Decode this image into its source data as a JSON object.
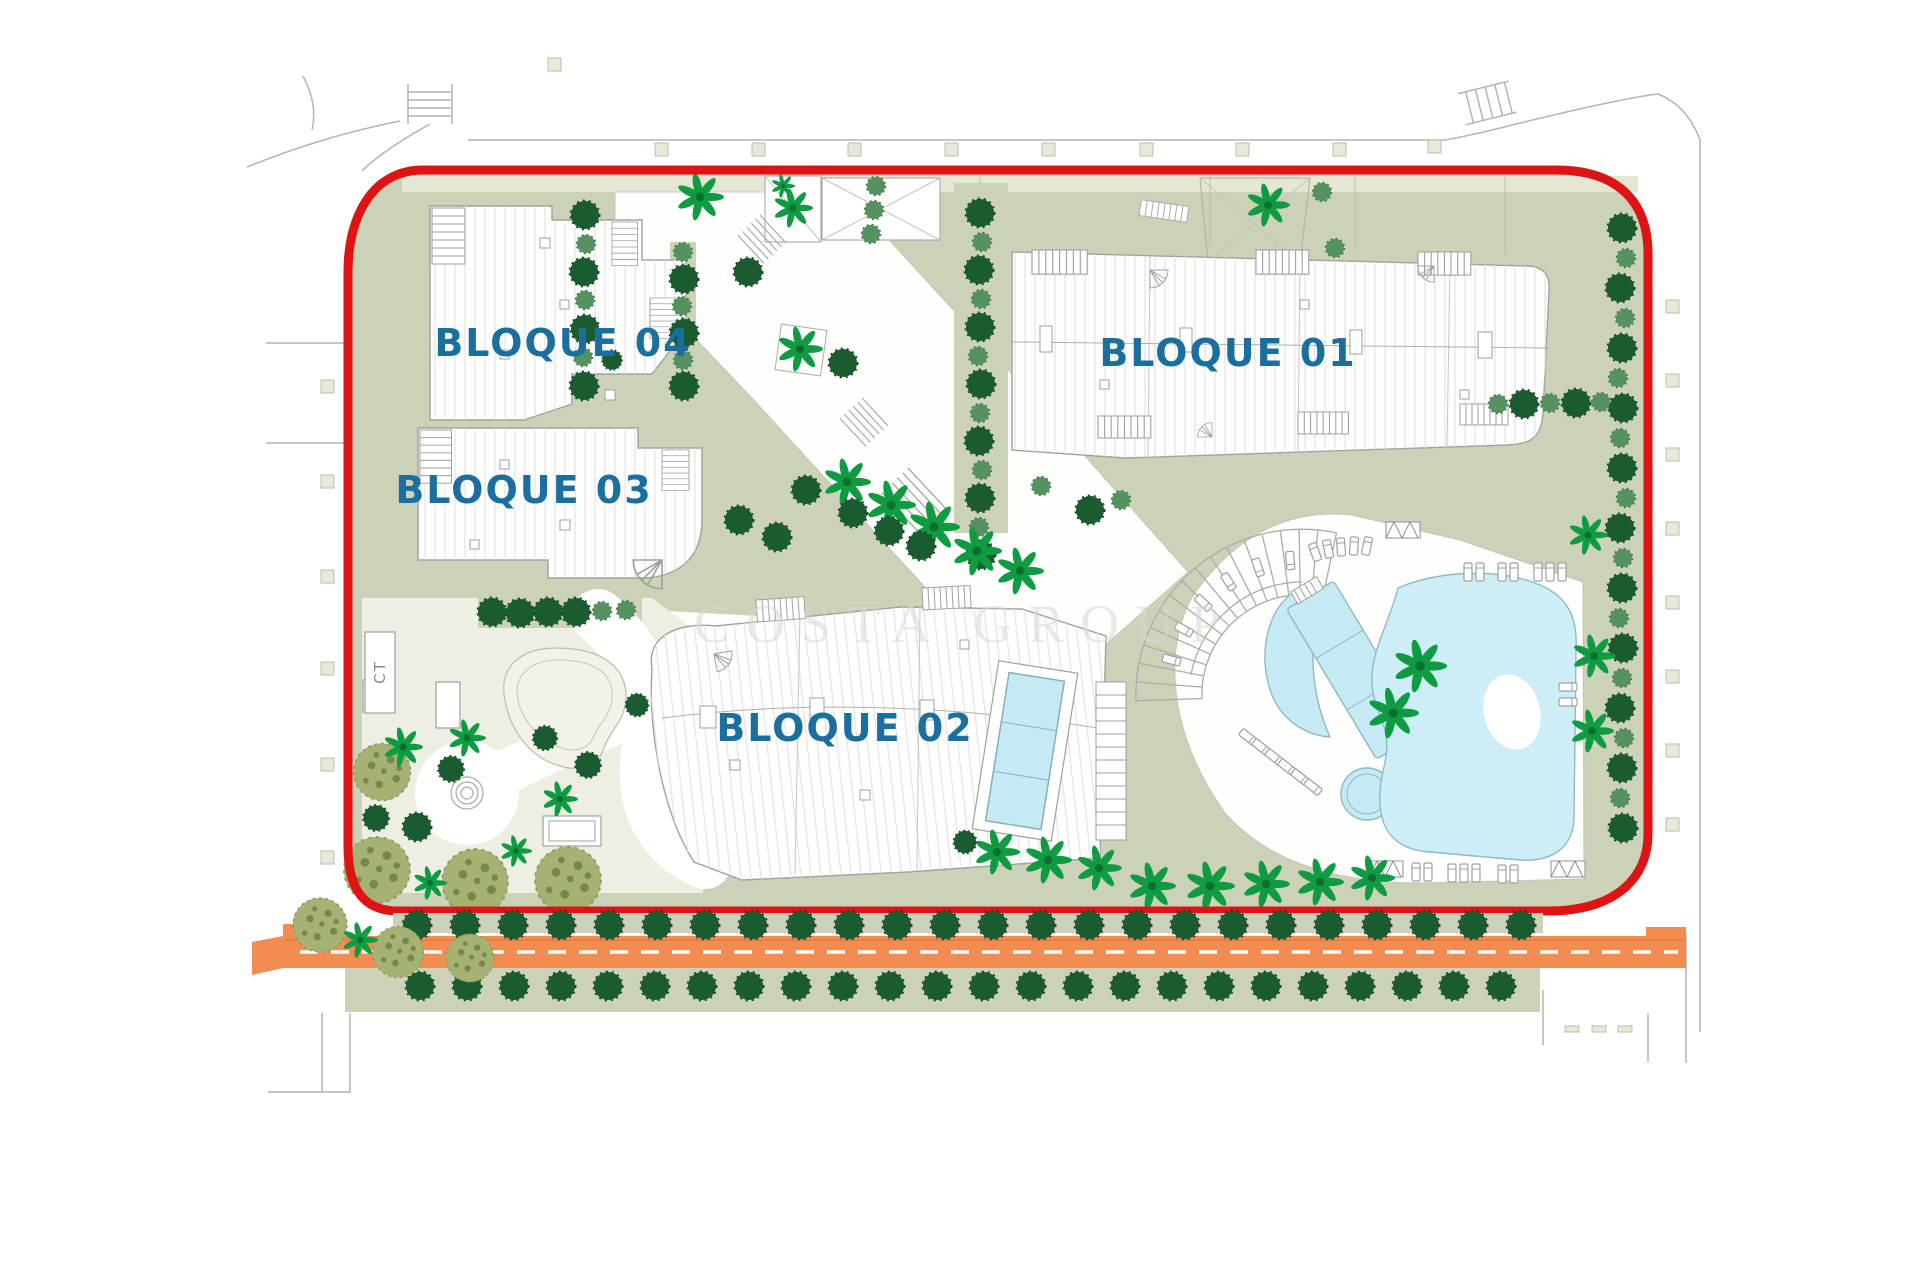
{
  "plan_title": "Residential complex site plan",
  "labels": {
    "bloque01": "BLOQUE 01",
    "bloque02": "BLOQUE 02",
    "bloque03": "BLOQUE 03",
    "bloque04": "BLOQUE 04",
    "ct": "CT",
    "watermark": "COSTA GROUP"
  },
  "colors": {
    "boundary_red": "#de1414",
    "label_blue": "#1a6f9e",
    "road_orange": "#f28c50",
    "pool_cyan": "#c6eaf4",
    "lagoon_cyan": "#cdeef7",
    "sage_green": "#cbd2b8",
    "pale_garden": "#edefe3",
    "tree_dark": "#1a5c30",
    "tree_medium": "#55925f",
    "palm_green": "#0f9b42",
    "bush_olive": "#a5b273",
    "outline_gray": "#b4b4b4"
  }
}
